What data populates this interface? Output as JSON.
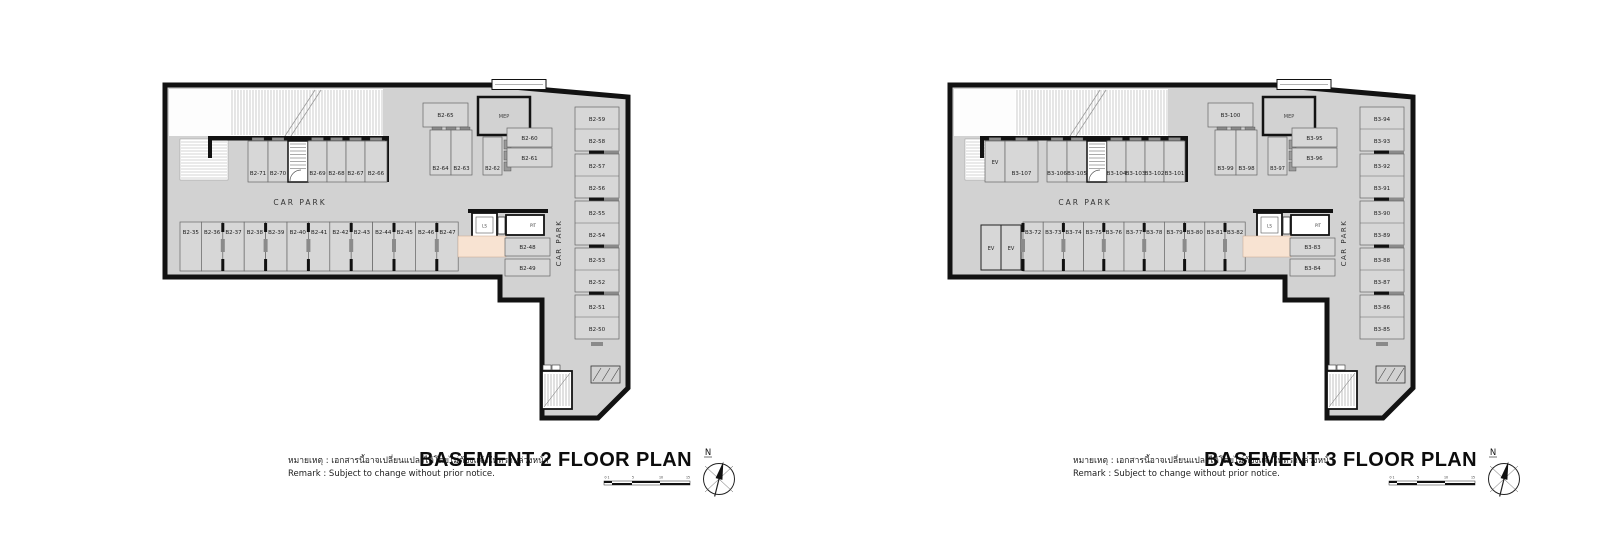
{
  "shared": {
    "car_park": "CAR PARK",
    "car_park_side": "CAR PARK",
    "mep": "MEP",
    "ls": "LS",
    "pit": "PIT",
    "ev": "EV",
    "north": "N",
    "scale_labels": [
      "0 1",
      "5",
      "10",
      "15"
    ]
  },
  "colors": {
    "floor": "#d2d2d2",
    "stall": "#d7d7d7",
    "wall": "#121212",
    "lobby": "#f8e3d2",
    "hatch": "#a9a9a9",
    "bumper": "#8a8a8a"
  },
  "plans": [
    {
      "title": "BASEMENT 2 FLOOR PLAN",
      "remark_thai": "หมายเหตุ : เอกสารนี้อาจเปลี่ยนแปลงได้โดยไม่ต้องแจ้งให้ทราบล่วงหน้า",
      "remark_en": "Remark  :  Subject to change without prior notice.",
      "top_row": [
        "B2-71",
        "B2-70",
        "B2-69",
        "B2-68",
        "B2-67",
        "B2-66"
      ],
      "bottom_row": [
        "B2-35",
        "B2-36",
        "B2-37",
        "B2-38",
        "B2-39",
        "B2-40",
        "B2-41",
        "B2-42",
        "B2-43",
        "B2-44",
        "B2-45",
        "B2-46",
        "B2-47"
      ],
      "right_column": [
        "B2-59",
        "B2-58",
        "B2-57",
        "B2-56",
        "B2-55",
        "B2-54",
        "B2-53",
        "B2-52",
        "B2-51",
        "B2-50"
      ],
      "cluster": {
        "wide_top": "B2-65",
        "pair_vertical": [
          "B2-64",
          "B2-63"
        ],
        "single_vertical": "B2-62",
        "right_stack": [
          "B2-60",
          "B2-61"
        ],
        "below_lift": [
          "B2-48",
          "B2-49"
        ]
      }
    },
    {
      "title": "BASEMENT 3 FLOOR PLAN",
      "remark_thai": "หมายเหตุ : เอกสารนี้อาจเปลี่ยนแปลงได้โดยไม่ต้องแจ้งให้ทราบล่วงหน้า",
      "remark_en": "Remark  :  Subject to change without prior notice.",
      "top_row": [
        "B3-107",
        "B3-106",
        "B3-105",
        "B3-104",
        "B3-103",
        "B3-102",
        "B3-101"
      ],
      "bottom_row": [
        "B3-72",
        "B3-73",
        "B3-74",
        "B3-75",
        "B3-76",
        "B3-77",
        "B3-78",
        "B3-79",
        "B3-80",
        "B3-81",
        "B3-82"
      ],
      "right_column": [
        "B3-94",
        "B3-93",
        "B3-92",
        "B3-91",
        "B3-90",
        "B3-89",
        "B3-88",
        "B3-87",
        "B3-86",
        "B3-85"
      ],
      "cluster": {
        "wide_top": "B3-100",
        "pair_vertical": [
          "B3-99",
          "B3-98"
        ],
        "single_vertical": "B3-97",
        "right_stack": [
          "B3-95",
          "B3-96"
        ],
        "below_lift": [
          "B3-83",
          "B3-84"
        ]
      }
    }
  ]
}
